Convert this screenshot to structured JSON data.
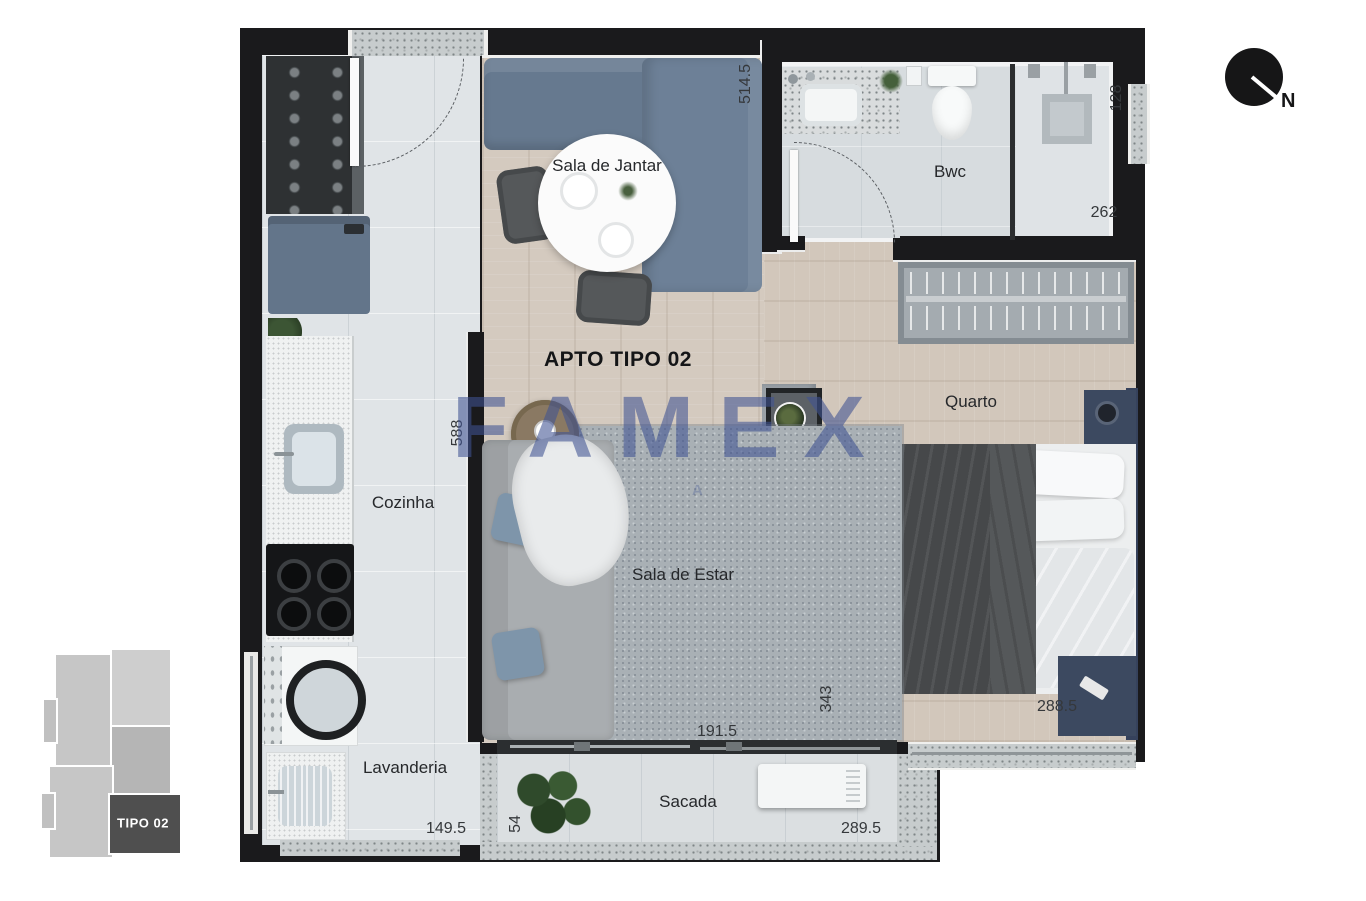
{
  "meta": {
    "plan_title": "APTO TIPO 02"
  },
  "watermark": {
    "text": "FAMEX",
    "subtext": "A",
    "color": "#405292"
  },
  "compass": {
    "north_label": "N"
  },
  "keyplan": {
    "unit_label": "TIPO 02",
    "highlight_color": "#4f4f4f"
  },
  "rooms": {
    "dining": {
      "label": "Sala de Jantar"
    },
    "bathroom": {
      "label": "Bwc"
    },
    "kitchen": {
      "label": "Cozinha"
    },
    "bedroom": {
      "label": "Quarto"
    },
    "living": {
      "label": "Sala de Estar"
    },
    "laundry": {
      "label": "Lavanderia"
    },
    "balcony": {
      "label": "Sacada"
    }
  },
  "dimensions": {
    "dining_right": "514.5",
    "bathroom_window": "128",
    "bathroom_width": "262",
    "kitchen_height": "588",
    "rack_height": "343",
    "bedroom_width": "288.5",
    "living_width": "191.5",
    "laundry_width": "149.5",
    "balcony_depth": "54",
    "balcony_width": "289.5"
  },
  "colors": {
    "walls": "#1a1a1c",
    "wood_floor": "#d4cabf",
    "tile_floor": "#e0e4e7",
    "sofa_blue": "#6b7e97",
    "bed_blanket": "#46484a"
  }
}
